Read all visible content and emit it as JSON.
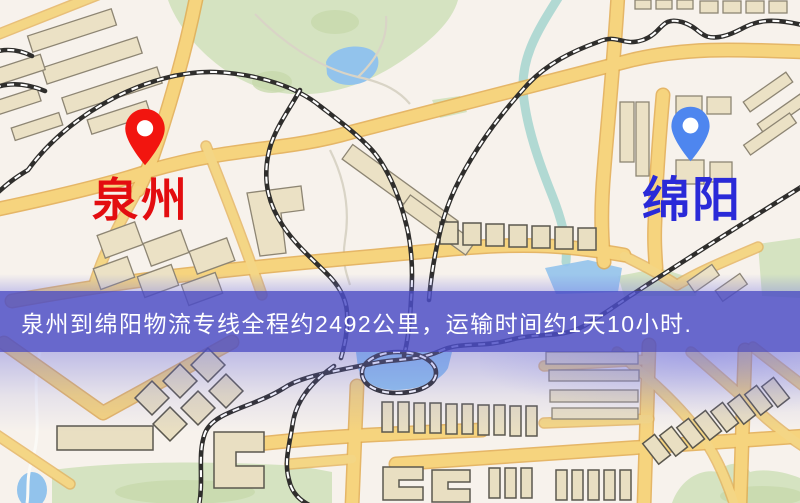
{
  "map": {
    "origin": {
      "name": "泉州",
      "pin_color": "#f2150f",
      "label_color": "#e30d10"
    },
    "destination": {
      "name": "绵阳",
      "pin_color": "#4e86ef",
      "label_color": "#2a2ad8"
    },
    "feature_colors": {
      "road_yellow": "#f6d47e",
      "building_tan": "#ebe1c5",
      "park_green": "#d5e3c1",
      "water_blue": "#92c3ec",
      "railway_black": "#2f2e2c"
    }
  },
  "banner": {
    "text": "泉州到绵阳物流专线全程约2492公里，运输时间约1天10小时.",
    "background_color": "#4c4dc6",
    "text_color": "#ffffff",
    "distance_km": "2492",
    "transit_time": "1天10小时"
  },
  "icons": {
    "origin_pin": "map-pin",
    "destination_pin": "map-pin"
  }
}
